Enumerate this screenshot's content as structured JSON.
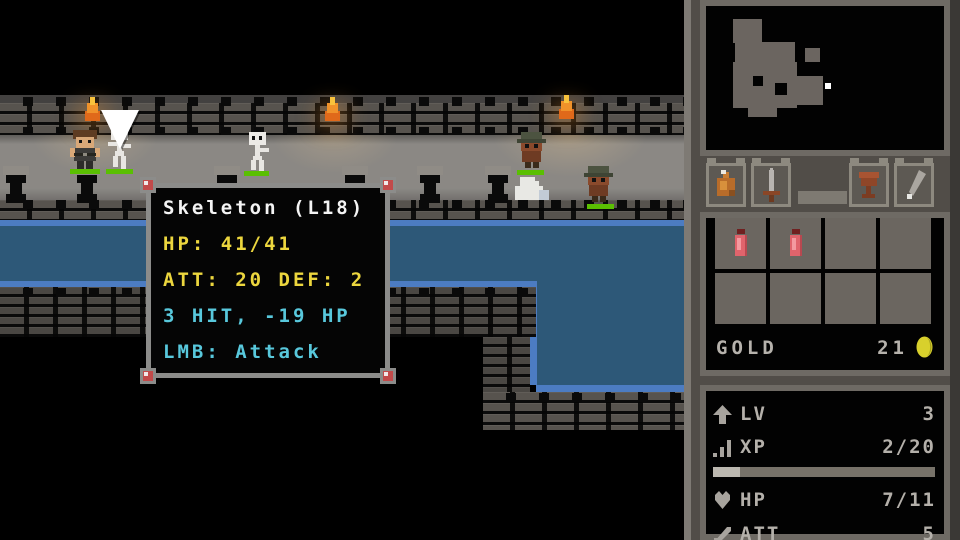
{
  "colors": {
    "tooltip_yellow": "#ecd63e",
    "tooltip_cyan": "#58c8dc",
    "hp_bar_green": "#5abf02",
    "water_blue": "#2d5878",
    "water_edge_blue": "#4c7cc2",
    "gold_coin": "#d8d02c"
  },
  "game": {
    "tooltip": {
      "title": "Skeleton (L18)",
      "hp_line": "HP: 41/41",
      "att_def_line": "ATT: 20 DEF: 2",
      "hit_line": "3 HIT, -19 HP",
      "lmb_line": "LMB: Attack"
    },
    "entities": [
      "player",
      "skeleton",
      "skeleton",
      "goblin",
      "ghost",
      "goblin"
    ]
  },
  "sidebar": {
    "hotbar": {
      "slots": [
        "potion",
        "sword",
        "empty",
        "goblet",
        "feather"
      ]
    },
    "inventory": {
      "items": [
        "red-potion",
        "red-potion",
        "",
        "",
        "",
        "",
        "",
        ""
      ],
      "gold_label": "GOLD",
      "gold_value": "21"
    },
    "stats": {
      "lv": {
        "label": "LV",
        "value": "3"
      },
      "xp": {
        "label": "XP",
        "value": "2/20",
        "fill_pct": 12
      },
      "hp": {
        "label": "HP",
        "value": "7/11"
      },
      "att": {
        "label": "ATT",
        "value": "5"
      }
    }
  }
}
